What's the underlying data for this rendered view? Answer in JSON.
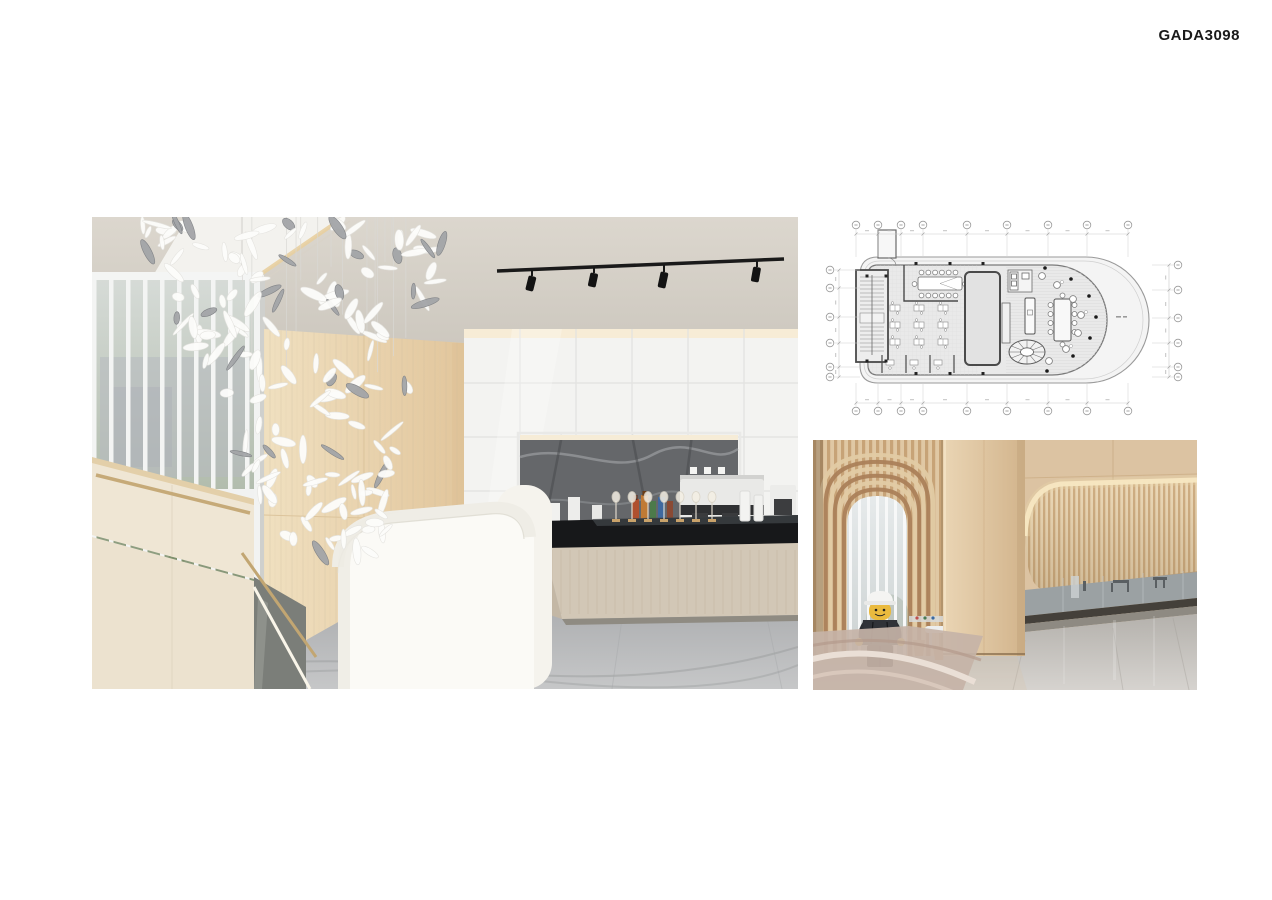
{
  "page": {
    "background_color": "#ffffff",
    "project_code": "GADA3098",
    "code_text_color": "#1a1a1a"
  },
  "panels": {
    "main_photo": {
      "label": "cafe-lounge-interior-photo"
    },
    "floor_plan": {
      "label": "floor-plan-line-drawing"
    },
    "lobby_photo": {
      "label": "lobby-slat-wall-interior-photo"
    }
  },
  "colors": {
    "ceiling_greige": "#d8d3c9",
    "cove_white": "#f3f2ee",
    "cove_glow": "#e8cfa0",
    "wood_panel": "#e8d2ad",
    "cabinet_white": "#f3f3f1",
    "backsplash_marble": "#65676a",
    "island_top_black": "#17181a",
    "island_wood": "#d2c7b6",
    "floor_marble_grey": "#a9abad",
    "stair_cream": "#efe6d4",
    "handrail_bronze": "#c6aa78",
    "smooth_wood": "#dcc3a2",
    "slat_wood": "#c7a377",
    "slat_wood_light": "#e0c8a4",
    "glow_warm": "#f7e7c2",
    "lego_yellow": "#eaba3e",
    "lego_dark": "#303338",
    "pink_marble": "#c6b3a7",
    "plan_line_dark": "#4a4a4a",
    "plan_line_light": "#9b9b9b",
    "plan_fill": "#efefef"
  }
}
